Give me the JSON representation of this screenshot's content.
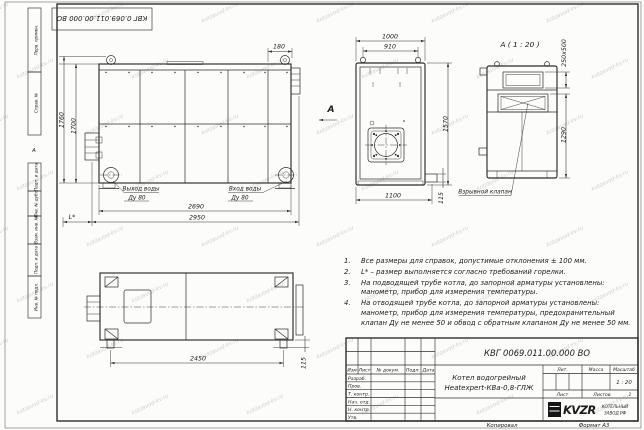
{
  "watermark": {
    "text": "kotzavod-kv.ru"
  },
  "stamp": {
    "designation_rotated": "КВГ 0.069.011.00.000 ВО"
  },
  "frame": {
    "side_labels": [
      "Перв. примен.",
      "Справ. №",
      "Подп. и дата",
      "Инв. № дубл.",
      "Взам. инв. №",
      "Подп. и дата",
      "Инв. № подл."
    ],
    "zone_marker": "А",
    "copied_label": "Копировал",
    "format_label": "Формат А3"
  },
  "views": {
    "side": {
      "dims": {
        "height_outer": "1760",
        "height_inner": "1700",
        "top_offset": "180",
        "length_inner": "2690",
        "length_outer": "2950",
        "burner_length": "L*"
      },
      "water_outlet": [
        "Выход воды",
        "Ду 80"
      ],
      "water_inlet": [
        "Вход воды",
        "Ду 80"
      ],
      "section_arrow": "А"
    },
    "front": {
      "dims": {
        "width_outer": "1000",
        "width_lugs": "910",
        "height": "1570",
        "width_base": "1100",
        "stub_height": "115"
      }
    },
    "detail": {
      "title": "А ( 1 : 20 )",
      "dims": {
        "flue_size": "250х500",
        "valve_height": "1290"
      },
      "valve_label": "Взрывной клапан"
    },
    "plan": {
      "dims": {
        "feet_span": "2450",
        "foot_offset": "115"
      }
    }
  },
  "notes": [
    {
      "num": "1.",
      "text": "Все размеры для справок, допустимые отклонения ± 100 мм."
    },
    {
      "num": "2.",
      "text": "L* – размер выполняется согласно требований горелки."
    },
    {
      "num": "3.",
      "text": "На подводящей трубе котла, до запорной арматуры установлены: манометр, прибор для измерения температуры."
    },
    {
      "num": "4.",
      "text": "На отводящей трубе котла, до запорной арматуры установлены: манометр, прибор для измерения температуры, предохранительный клапан Ду не менее 50 и обвод с обратным клапаном Ду не менее 50 мм."
    }
  ],
  "title_block": {
    "designation": "КВГ 0069.011.00.000 ВО",
    "product_name": [
      "Котел водогрейный",
      "Heatexpert-КВа-0,8-ГЛЖ"
    ],
    "col_headers": [
      "Изм",
      "Лист",
      "№ докум.",
      "Подп.",
      "Дата"
    ],
    "row_labels": [
      "Разраб.",
      "Пров.",
      "Т. контр.",
      "Нач. отд.",
      "Н. контр.",
      "Утв."
    ],
    "lit_label": "Лит.",
    "mass_label": "Масса",
    "scale_label": "Масштаб",
    "scale_value": "1 : 20",
    "sheet_label": "Лист",
    "sheets_label": "Листов",
    "sheets_value": "1",
    "logo_text": "KVZR",
    "company": [
      "КОТЕЛЬНЫЙ",
      "ЗАВОД РФ"
    ]
  }
}
